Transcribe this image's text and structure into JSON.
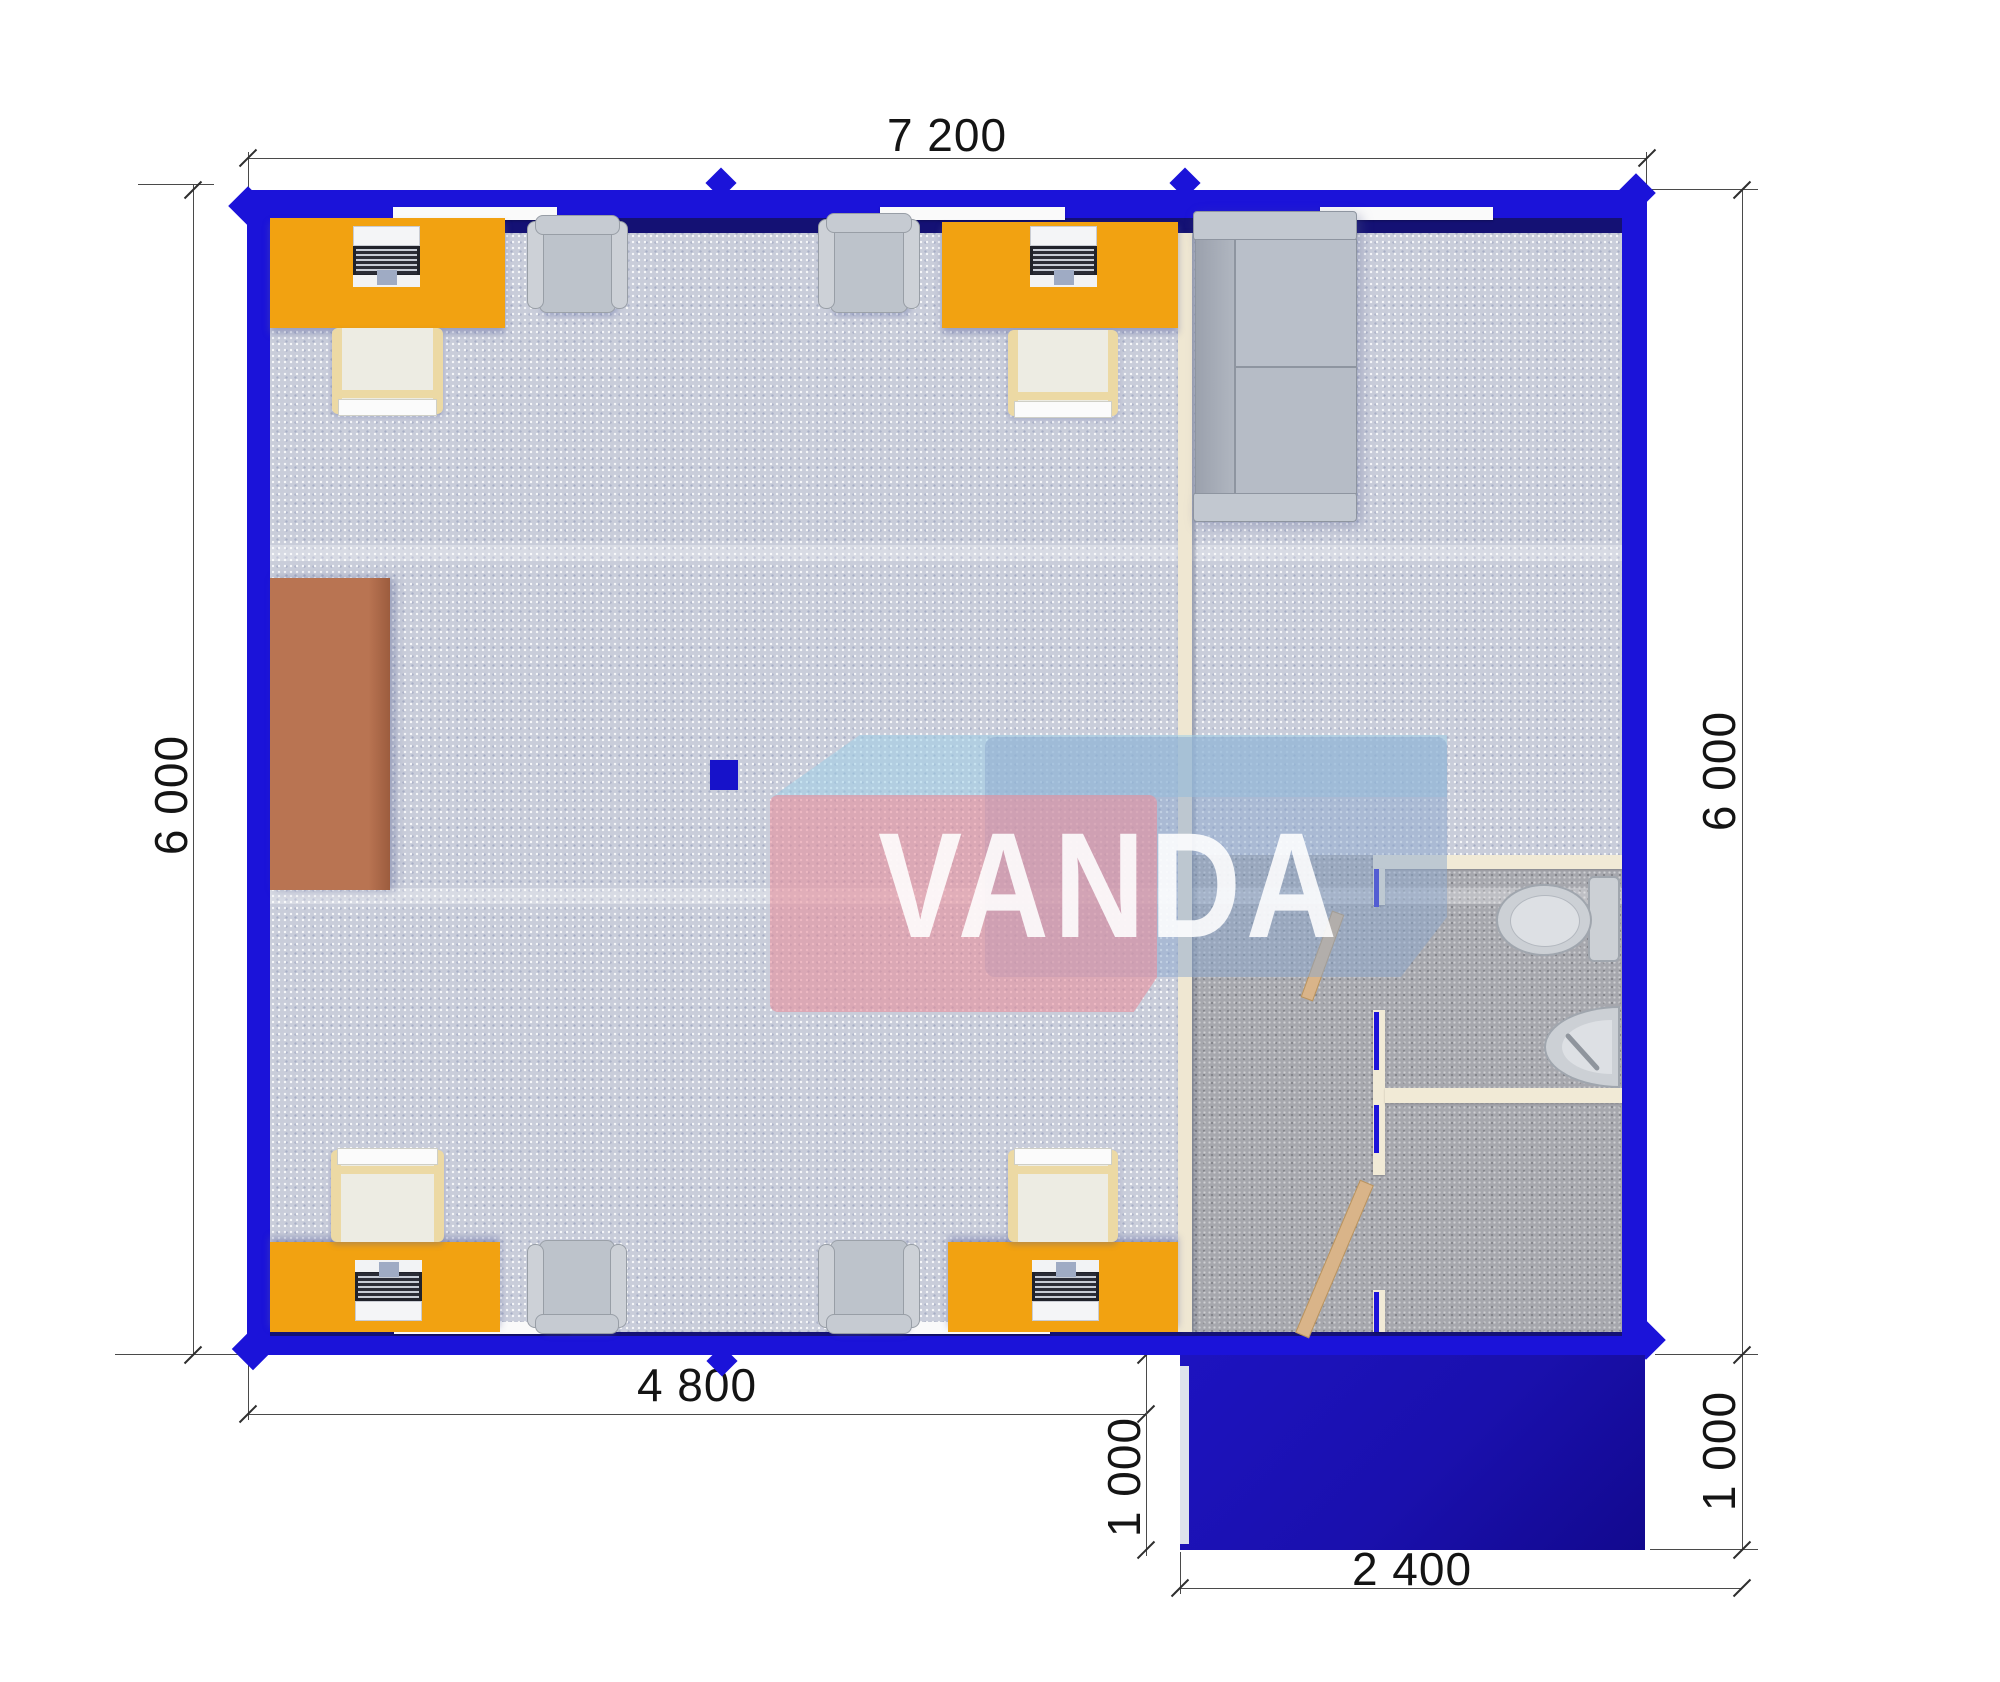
{
  "brand": {
    "logo_text": "VANDA"
  },
  "dimensions": {
    "overall_width": "7 200",
    "left_depth": "6 000",
    "right_depth": "6 000",
    "office_width": "4 800",
    "porch_depth_left": "1 000",
    "porch_depth_right": "1 000",
    "porch_width": "2 400"
  },
  "colors": {
    "wall_blue": "#1b13d9",
    "wall_navy": "#141174",
    "porch_navy": "#1a10ad",
    "desk_orange": "#f2a211",
    "cabinet_brown": "#b97452",
    "partition_cream": "#efe7d2",
    "bath_wall_cream": "#f1ead6",
    "floor_light_base": "#c9cdda",
    "floor_dark_base": "#a6a7ad",
    "furniture_gray": "#bdc3cb",
    "chair_frame_tan": "#ecd9a4",
    "door_wood": "#d9b489",
    "logo_pink": "rgba(231,144,156,0.6)",
    "logo_steel": "rgba(140,168,205,0.5)",
    "logo_lightblue": "rgba(158,208,232,0.55)",
    "dim_line": "#4a4a4a",
    "dim_text": "#141414",
    "window_white": "#fafafa"
  }
}
